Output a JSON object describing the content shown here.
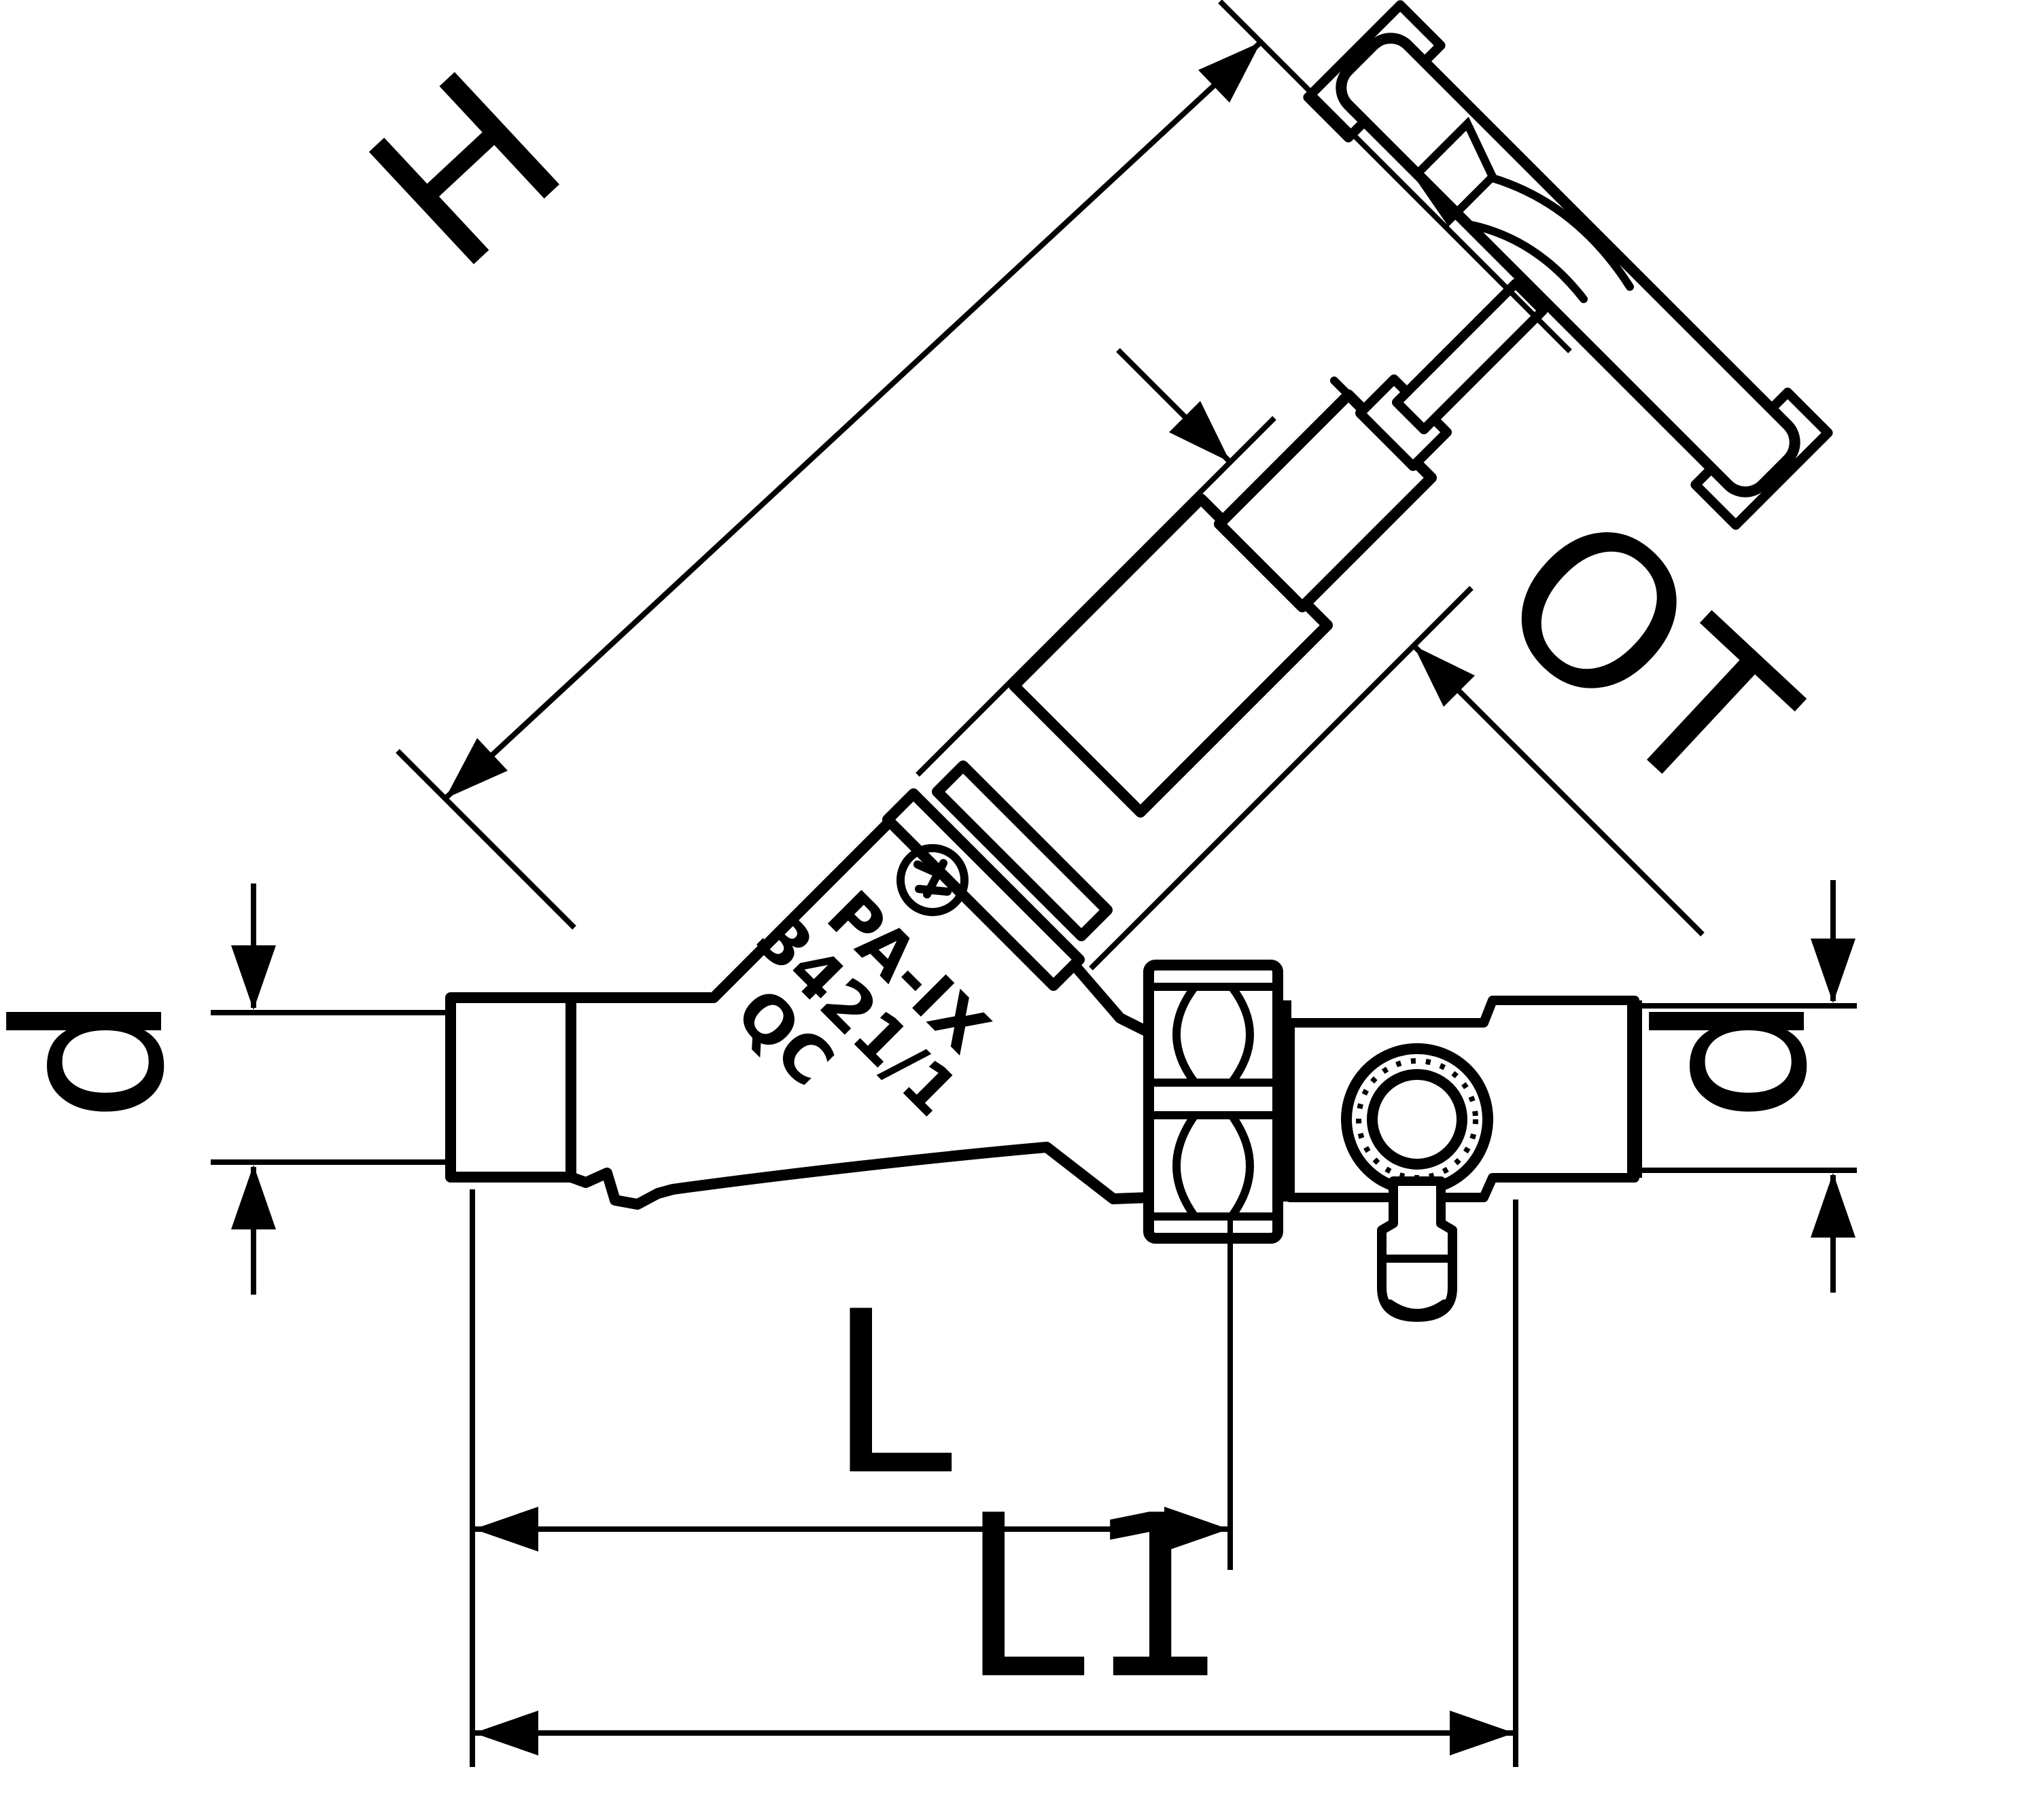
{
  "drawing": {
    "type": "technical-dimension-drawing",
    "subject": "slanted-seat valve with drain, side view",
    "colors": {
      "ink": "#000000",
      "paper": "#ffffff"
    },
    "dimensions": {
      "height_label": "H",
      "headwork_label": "OT",
      "diameter_left_label": "d",
      "diameter_right_label": "d",
      "length_label": "L",
      "overall_length_label": "L1"
    },
    "body_markings": {
      "line1": "PA-IX",
      "line2": "3421/1",
      "line3": "QC"
    },
    "icons": {
      "logo": "manufacturer-logo-icon"
    }
  }
}
